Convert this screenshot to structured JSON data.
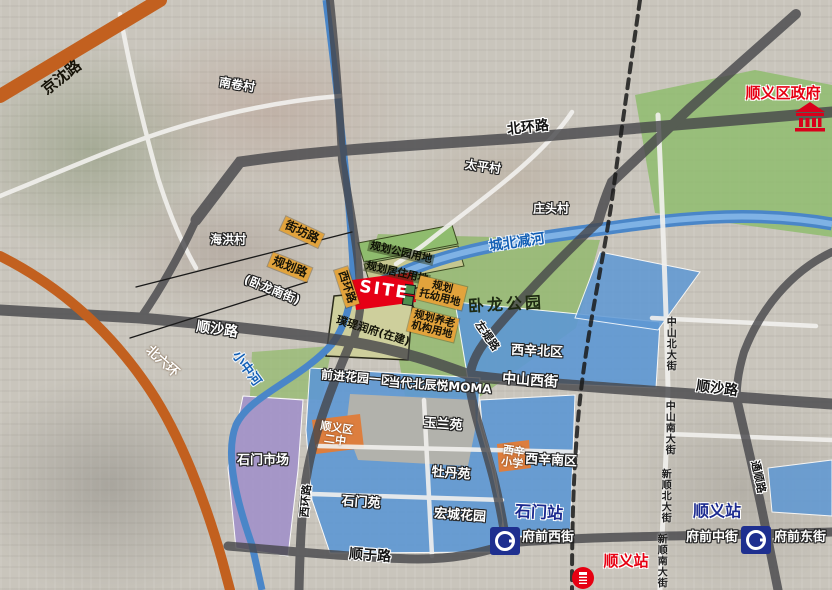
{
  "site": {
    "label": "SITE"
  },
  "planning": {
    "park": "规划公园用地",
    "residential": "规划居住用地",
    "kindergarten": {
      "line1": "规划",
      "line2": "托幼用地"
    },
    "elderly": {
      "line1": "规划养老",
      "line2": "机构用地"
    },
    "under_construction": "璞瑅润府(在建)"
  },
  "roads": {
    "jingshen": "京沈路",
    "beihuan": "北环路",
    "jiefang": "街坊路",
    "guihua": "规划路",
    "wolong_south_alias": "(卧龙南街)",
    "xihuan": "西环路",
    "xihuan_south": "西环路",
    "shunsha_west": "顺沙路",
    "shunsha_east": "顺沙路",
    "zhongshan_west_st": "中山西街",
    "beiliuhuan": "北六环",
    "zuodi": "左堤路",
    "shunyu": "顺于路",
    "fuqian_west": "府前西街",
    "fuqian_middle": "府前中街",
    "fuqian_east": "府前东街",
    "zhongshan_north_ave": "中山北大街",
    "zhongshan_south_ave": "中山南大街",
    "xinshun_north_ave": "新顺北大街",
    "xinshun_south_ave": "新顺南大街",
    "tongshun": "通顺路"
  },
  "waterways": {
    "chengbei_jianhe": "城北减河",
    "xiaozhong_river": "小中河"
  },
  "villages": {
    "nanjuan": "南卷村",
    "taiping": "太平村",
    "zhuangtou": "庄头村",
    "haihong": "海洪村"
  },
  "parks": {
    "wolong": "卧龙公园"
  },
  "neighborhoods": {
    "xixin_north": "西辛北区",
    "qianjin_garden": "前进花园一区",
    "moma": "当代北辰悦MOMA",
    "yulan": "玉兰苑",
    "mudan": "牡丹苑",
    "xixin_south": "西辛南区",
    "shimen_yuan": "石门苑",
    "hongcheng_garden": "宏城花园",
    "shimen_market": "石门市场"
  },
  "schools": {
    "shunyi_no2": {
      "line1": "顺义区",
      "line2": "二中"
    },
    "xixin_primary": {
      "line1": "西辛",
      "line2": "小学"
    }
  },
  "stations": {
    "shimen_metro": "石门站",
    "shunyi_metro": "顺义站",
    "shunyi_rail": "顺义站"
  },
  "government": {
    "shunyi_district": "顺义区政府"
  },
  "colors": {
    "site_red": "#e60015",
    "badge_orange": "#e2a33c",
    "zone_blue": "#5e98d4",
    "zone_purple": "#a393c9",
    "zone_green": "#93b96e",
    "road_orange": "#c2601f",
    "river_blue": "#4a86c8",
    "station_blue": "#1b2a8f",
    "gov_red": "#d9001b"
  }
}
